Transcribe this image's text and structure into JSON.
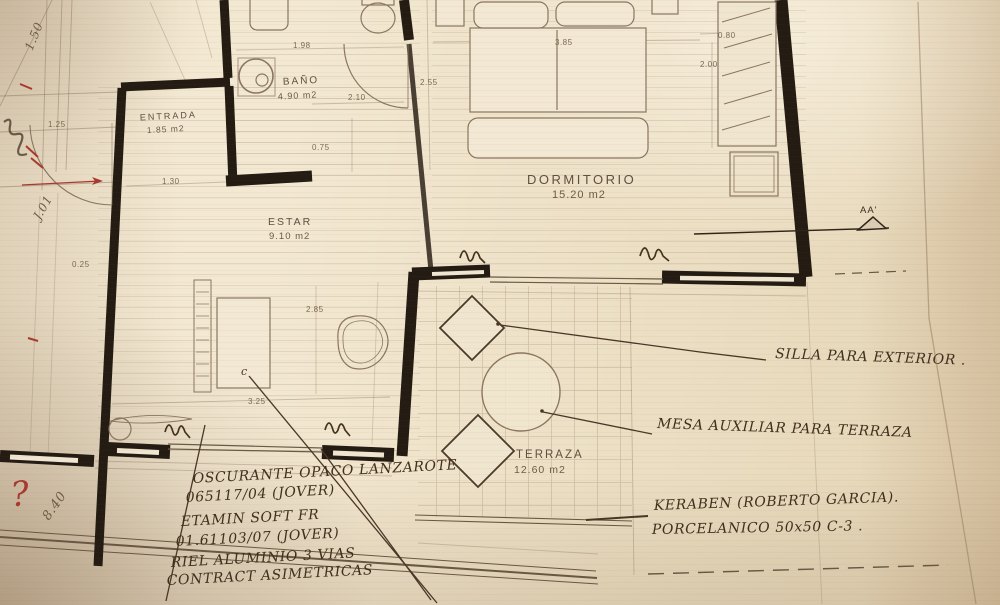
{
  "rooms": {
    "bano": {
      "name": "BAÑO",
      "area": "4.90 m2"
    },
    "entrada": {
      "name": "ENTRADA",
      "area": "1.85 m2"
    },
    "estar": {
      "name": "ESTAR",
      "area": "9.10 m2"
    },
    "dormitorio": {
      "name": "DORMITORIO",
      "area": "15.20 m2"
    },
    "terraza": {
      "name": "TERRAZA",
      "area": "12.60 m2"
    }
  },
  "dimensions": {
    "bano_width": "1.98",
    "bano_door": "2.10",
    "bano_side": "2.55",
    "bano_fixture": "0.75",
    "entrada_width": "1.30",
    "entry_door": "1.25",
    "wall_offset": "0.25",
    "bed_width": "3.85",
    "closet_width": "0.80",
    "closet_depth": "2.00",
    "estar_depth": "2.85",
    "estar_window": "3.25"
  },
  "handwritten": {
    "chair_note": "SILLA PARA EXTERIOR .",
    "table_note": "MESA AUXILIAR PARA TERRAZA",
    "tile_note_line1": "KERABEN (ROBERTO GARCIA).",
    "tile_note_line2": "PORCELANICO 50x50 C-3 .",
    "curtain_note_line1": "OSCURANTE OPACO LANZAROTE",
    "curtain_note_line2": "065117/04 (JOVER)",
    "fabric_note_line1": "ETAMIN SOFT FR",
    "fabric_note_line2": "01.61103/07 (JOVER)",
    "rail_note_line1": "RIEL ALUMINIO 3 VIAS",
    "rail_note_line2": "CONTRACT ASIMETRICAS",
    "question_mark": "?",
    "margin_note_top": "1.50",
    "margin_note_mid": "J.01",
    "margin_note_bottom": "8.40",
    "small_mark": "c"
  },
  "section_marker": {
    "label": "AA'"
  }
}
